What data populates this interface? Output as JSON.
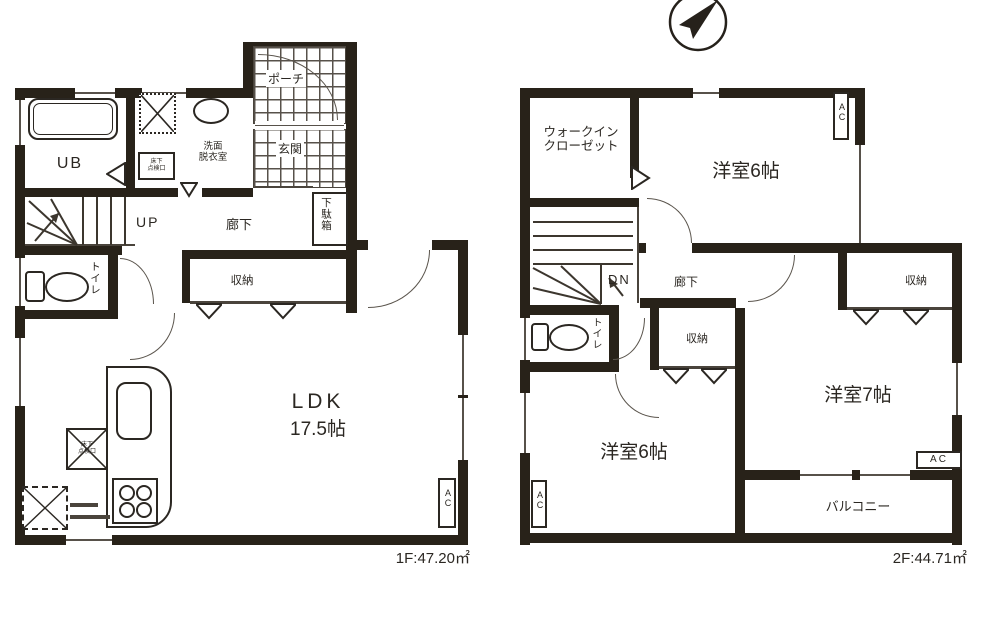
{
  "icons": {
    "compass": "north-arrow-icon"
  },
  "floor1": {
    "area_label": "1F:47.20㎡",
    "labels": {
      "ub": "UB",
      "washroom_l1": "洗面",
      "washroom_l2": "脱衣室",
      "hatch_l1": "床下",
      "hatch_l2": "点検口",
      "porch": "ポーチ",
      "entrance": "玄関",
      "shoe_cabinet": "下駄箱",
      "stairs": "UP",
      "hallway": "廊下",
      "toilet": "トイレ",
      "storage": "収納",
      "ldk": "LDK",
      "ldk_size": "17.5帖",
      "ac": "AC"
    }
  },
  "floor2": {
    "area_label": "2F:44.71㎡",
    "labels": {
      "wic_l1": "ウォークイン",
      "wic_l2": "クローゼット",
      "bedroom_ne": "洋室6帖",
      "stairs": "DN",
      "hallway": "廊下",
      "toilet": "トイレ",
      "storage_mid": "収納",
      "storage_east": "収納",
      "bedroom_sw": "洋室6帖",
      "bedroom_e": "洋室7帖",
      "balcony": "バルコニー",
      "ac": "AC"
    }
  }
}
